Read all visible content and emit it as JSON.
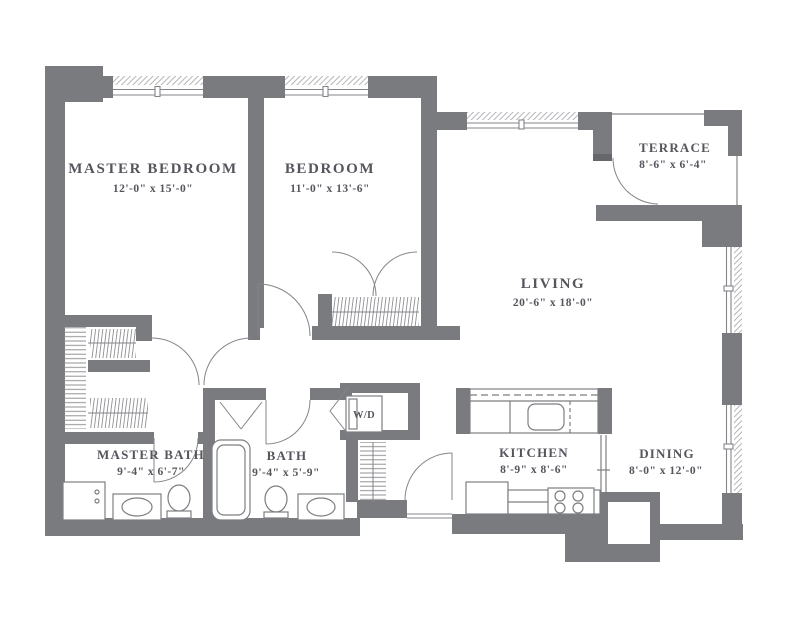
{
  "plan": {
    "type": "apartment-floor-plan",
    "bedrooms": 2,
    "baths": 2
  },
  "colors": {
    "wall": "#7a7b7f",
    "line": "#84858a",
    "fixture": "#7d7e82",
    "hatch": "#8f9094",
    "window_hatch": "#b4b5b9",
    "text": "#55555d",
    "background": "#ffffff"
  },
  "rooms": [
    {
      "id": "master-bedroom",
      "name": "MASTER BEDROOM",
      "dims": "12'-0\" x 15'-0\""
    },
    {
      "id": "bedroom",
      "name": "BEDROOM",
      "dims": "11'-0\" x 13'-6\""
    },
    {
      "id": "terrace",
      "name": "TERRACE",
      "dims": "8'-6\" x 6'-4\""
    },
    {
      "id": "living",
      "name": "LIVING",
      "dims": "20'-6\" x 18'-0\""
    },
    {
      "id": "master-bath",
      "name": "MASTER BATH",
      "dims": "9'-4\" x 6'-7\""
    },
    {
      "id": "bath",
      "name": "BATH",
      "dims": "9'-4\" x 5'-9\""
    },
    {
      "id": "kitchen",
      "name": "KITCHEN",
      "dims": "8'-9\" x 8'-6\""
    },
    {
      "id": "dining",
      "name": "DINING",
      "dims": "8'-0\" x 12'-0\""
    }
  ],
  "labels": {
    "washer_dryer": "W/D"
  }
}
